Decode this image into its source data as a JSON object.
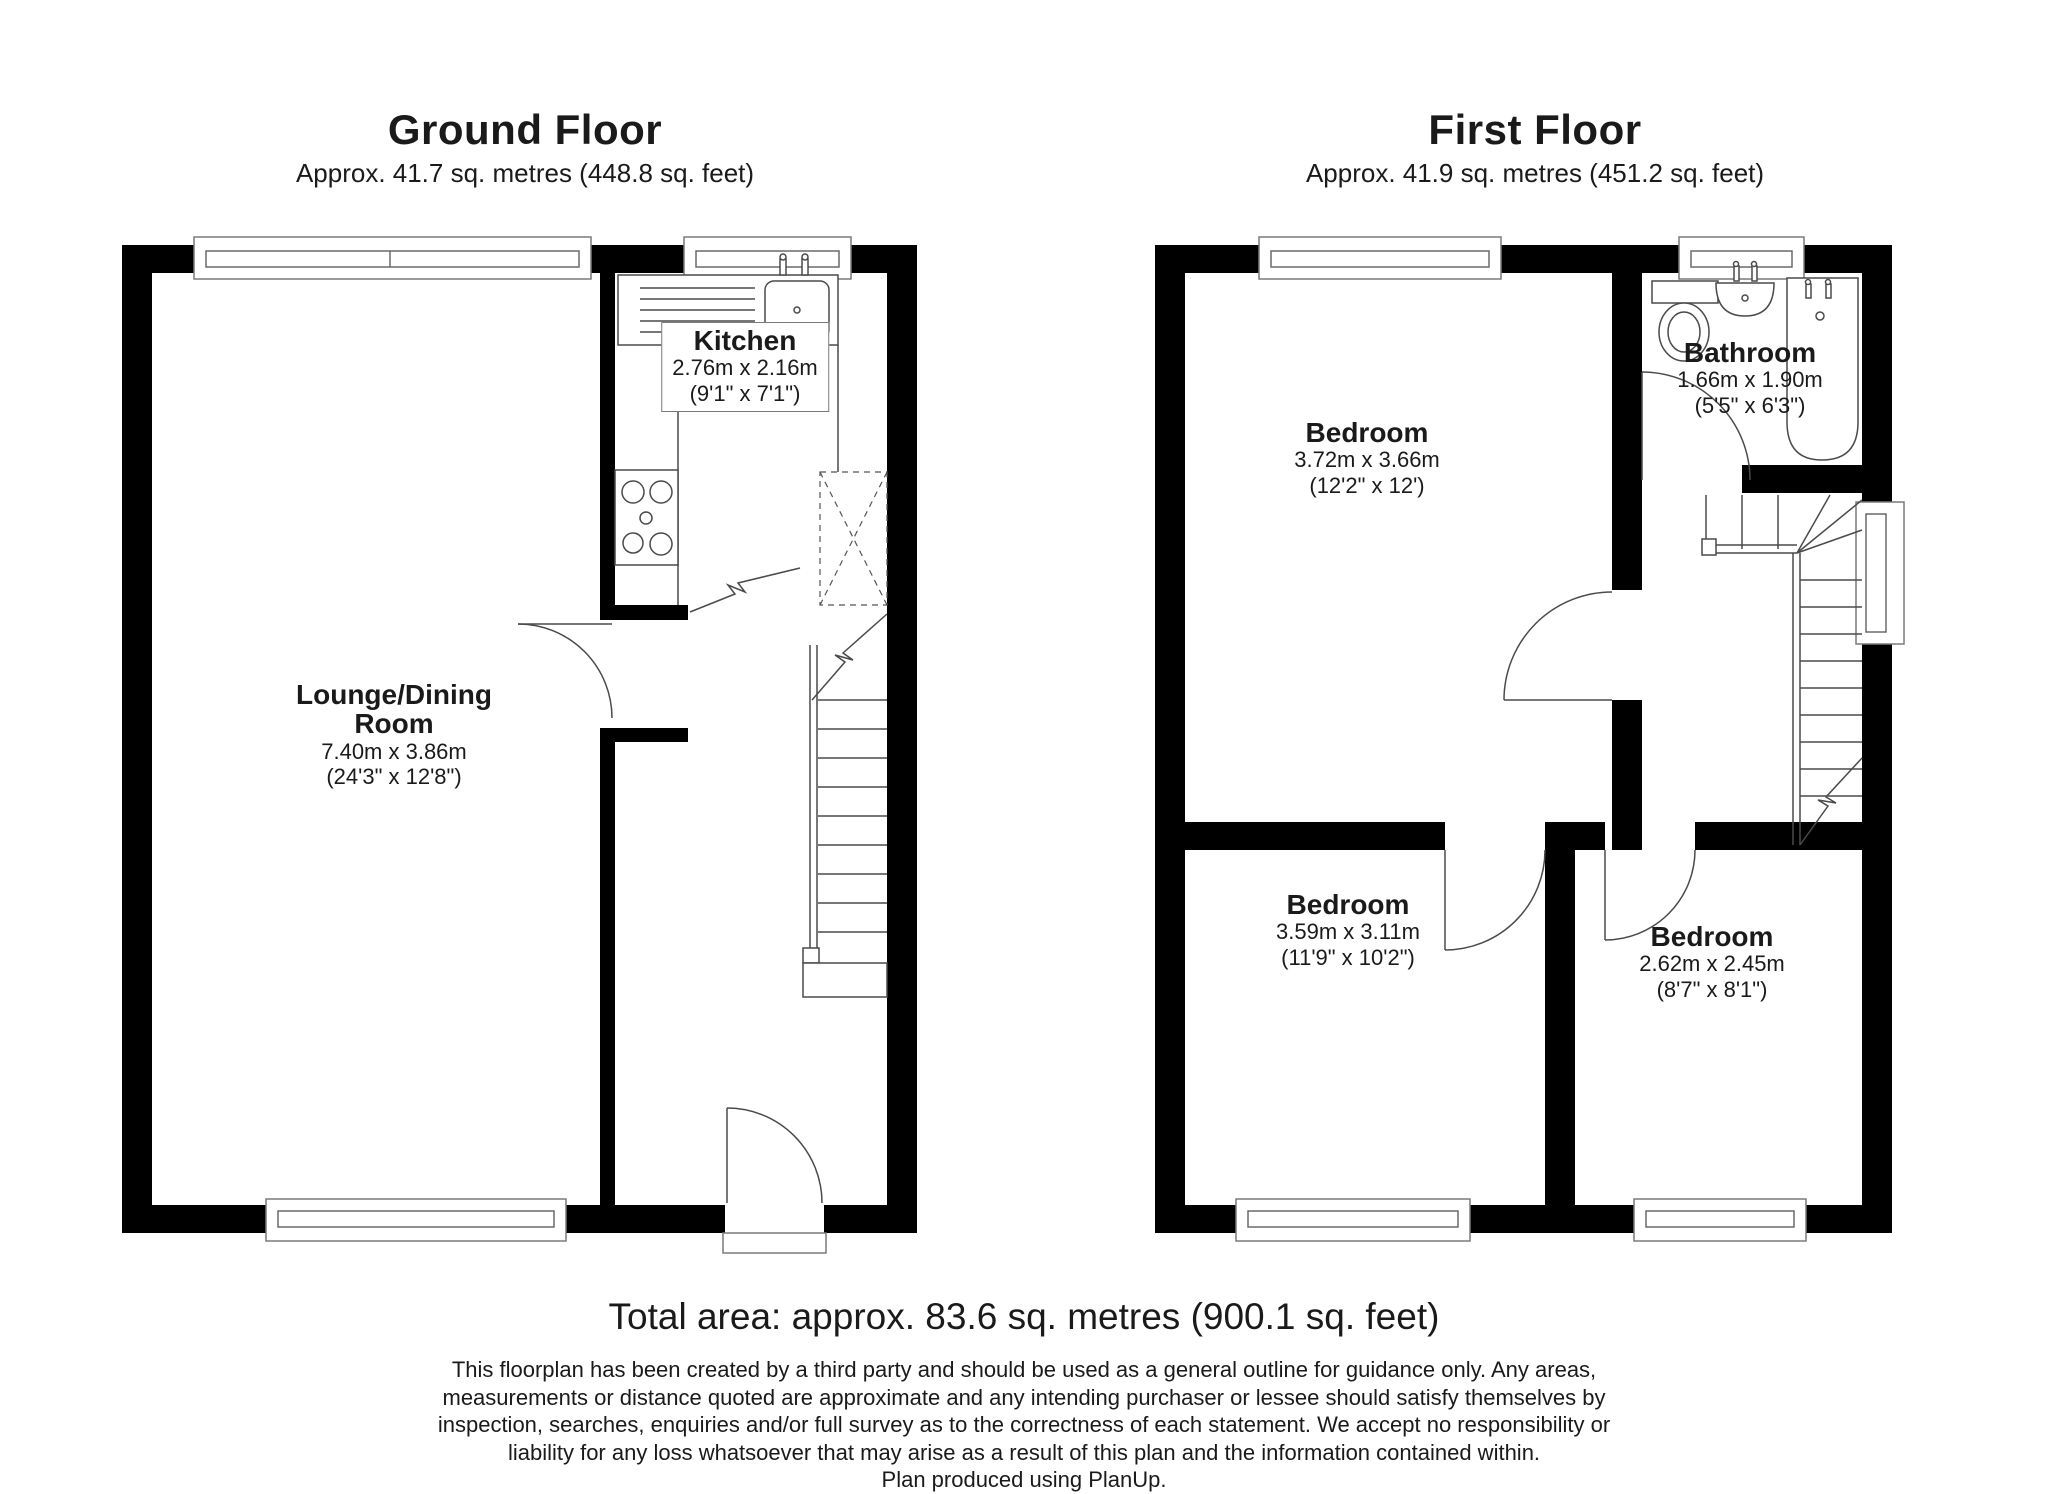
{
  "ground_floor": {
    "title": "Ground Floor",
    "subtitle": "Approx. 41.7 sq. metres (448.8 sq. feet)",
    "rooms": {
      "kitchen": {
        "name": "Kitchen",
        "metric": "2.76m x 2.16m",
        "imperial": "(9'1\" x 7'1\")"
      },
      "lounge": {
        "name_line1": "Lounge/Dining",
        "name_line2": "Room",
        "metric": "7.40m x 3.86m",
        "imperial": "(24'3\" x 12'8\")"
      }
    }
  },
  "first_floor": {
    "title": "First Floor",
    "subtitle": "Approx. 41.9 sq. metres (451.2 sq. feet)",
    "rooms": {
      "bedroom_main": {
        "name": "Bedroom",
        "metric": "3.72m x 3.66m",
        "imperial": "(12'2\" x 12')"
      },
      "bathroom": {
        "name": "Bathroom",
        "metric": "1.66m x 1.90m",
        "imperial": "(5'5\" x 6'3\")"
      },
      "bedroom_left": {
        "name": "Bedroom",
        "metric": "3.59m x 3.11m",
        "imperial": "(11'9\" x 10'2\")"
      },
      "bedroom_right": {
        "name": "Bedroom",
        "metric": "2.62m x 2.45m",
        "imperial": "(8'7\" x 8'1\")"
      }
    }
  },
  "footer": {
    "total_area": "Total area: approx. 83.6 sq. metres (900.1 sq. feet)",
    "disclaimer_lines": [
      "This floorplan has been created by a third party and should be used as a general outline for guidance only. Any areas,",
      "measurements or distance quoted are approximate and any intending purchaser or lessee should satisfy themselves by",
      "inspection, searches, enquiries and/or full survey as to the correctness of each statement. We accept no responsibility or",
      "liability for any loss whatsoever that may arise as a result of this plan and the information contained within."
    ],
    "credit": "Plan produced using PlanUp."
  }
}
